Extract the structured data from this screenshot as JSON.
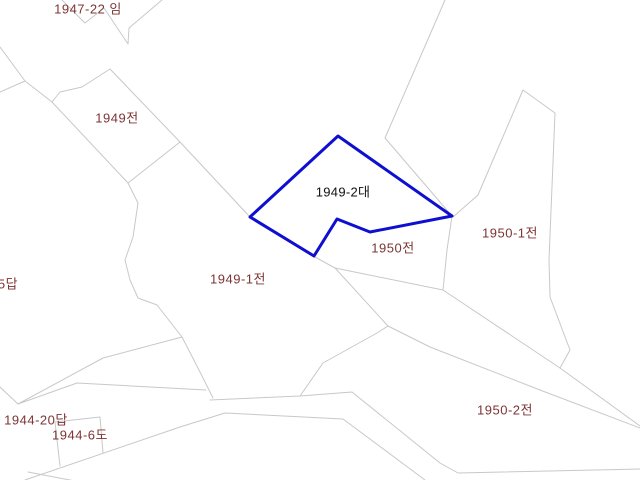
{
  "map": {
    "background_color": "#ffffff",
    "boundary_line_color": "#c8c8c8",
    "selected_outline_color": "#0f10cf",
    "label_color": "#7d3434",
    "selected_label_color": "#111111",
    "selected_parcel": "1949-2대",
    "parcels": [
      {
        "label": "1947-22 임",
        "x": 88,
        "y": 8,
        "selected": false
      },
      {
        "label": "1949전",
        "x": 117,
        "y": 117,
        "selected": false
      },
      {
        "label": "1949-2대",
        "x": 343,
        "y": 191,
        "selected": true
      },
      {
        "label": "1950전",
        "x": 393,
        "y": 247,
        "selected": false
      },
      {
        "label": "1950-1전",
        "x": 510,
        "y": 232,
        "selected": false
      },
      {
        "label": "1949-1전",
        "x": 238,
        "y": 278,
        "selected": false
      },
      {
        "label": "5답",
        "x": 8,
        "y": 283,
        "selected": false
      },
      {
        "label": "1944-20답",
        "x": 36,
        "y": 419,
        "selected": false
      },
      {
        "label": "1944-6도",
        "x": 80,
        "y": 434,
        "selected": false
      },
      {
        "label": "1950-2전",
        "x": 505,
        "y": 409,
        "selected": false
      }
    ]
  }
}
